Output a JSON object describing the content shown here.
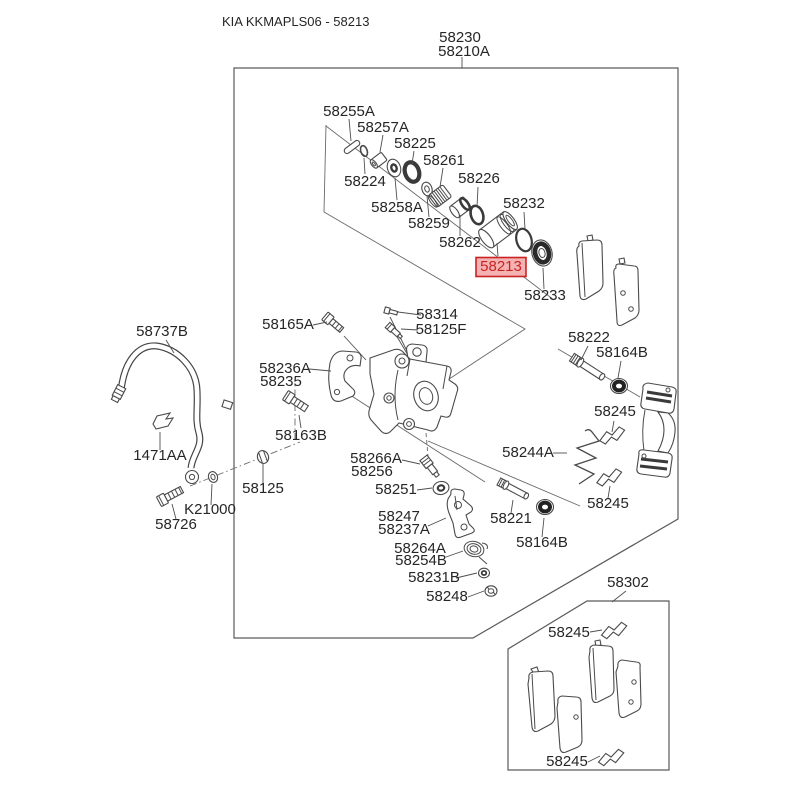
{
  "header": {
    "title": "KIA KKMAPLS06 - 58213"
  },
  "assembly": {
    "code": "58230",
    "variant": "58210A"
  },
  "highlight": {
    "code": "58213"
  },
  "colors": {
    "line": "#4a4a4a",
    "text": "#262626",
    "hl-bg": "#f4b2b2",
    "hl-border": "#c92323",
    "hl-text": "#c92323"
  },
  "part_labels": [
    "58255A",
    "58257A",
    "58225",
    "58261",
    "58224",
    "58226",
    "58258A",
    "58232",
    "58259",
    "58262",
    "58213",
    "58233",
    "58165A",
    "58314",
    "58125F",
    "58236A",
    "58235",
    "58163B",
    "58222",
    "58164B",
    "58245",
    "58244A",
    "58245",
    "58737B",
    "1471AA",
    "58125",
    "K21000",
    "58726",
    "58266A",
    "58256",
    "58251",
    "58247",
    "58237A",
    "58221",
    "58164B",
    "58264A",
    "58254B",
    "58231B",
    "58248",
    "58302",
    "58245",
    "58245"
  ]
}
